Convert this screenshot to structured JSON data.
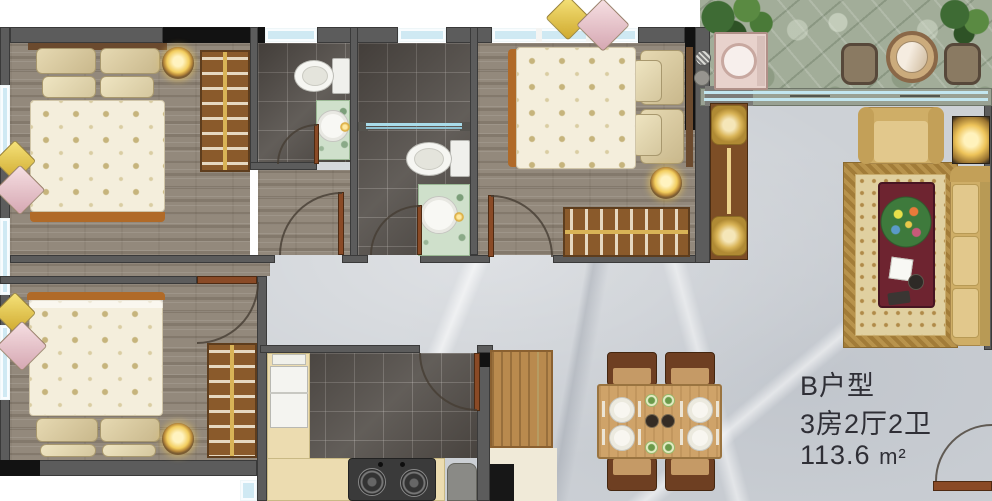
{
  "info_panel": {
    "unit_name": "B户型",
    "layout_spec": "3房2厅2卫",
    "area_value": "113.6",
    "area_unit": "m²"
  },
  "colors": {
    "wall": "#5c5c5c",
    "wall_black": "#121212",
    "window_glass": "#cfe9f3",
    "wood_floor": "#93897c",
    "tile_floor": "#55504b",
    "marble_floor": "#cdd1d6",
    "stone_paving": "#a2ad99",
    "kitchen_counter": "#ecdcb0",
    "sofa_gold": "#cfae67",
    "wardrobe_brown": "#8a5a2b",
    "door_brown": "#8a4a26",
    "lamp_glow": "#f2cd5e",
    "coffee_table_red": "#6e2430"
  }
}
